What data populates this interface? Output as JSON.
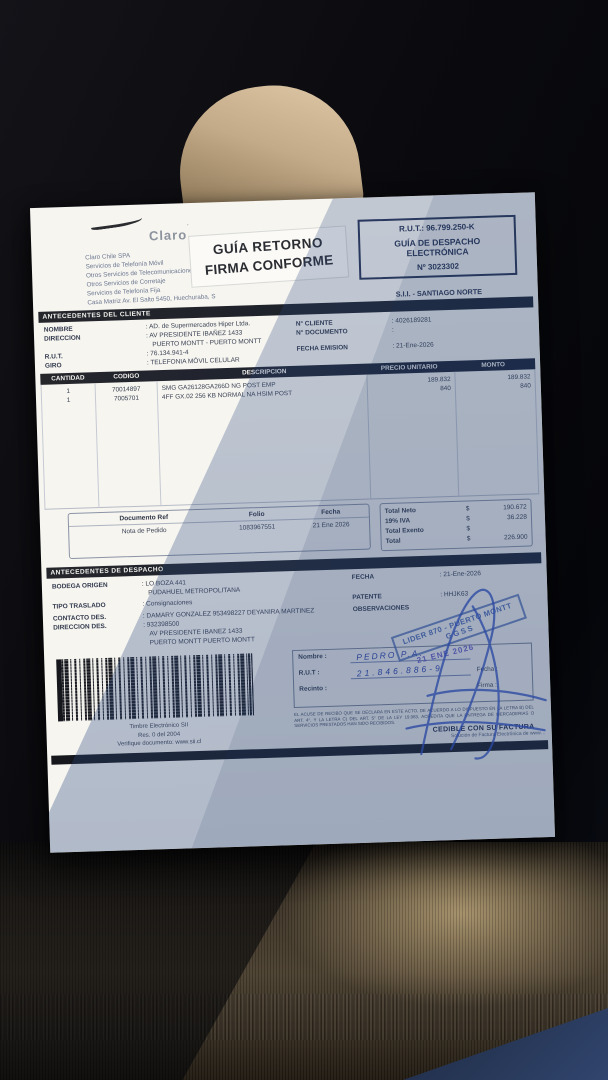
{
  "header": {
    "brand": "Claro",
    "brand_tick": "´",
    "company_lines": [
      "Claro Chile SPA",
      "Servicios de Telefonía Móvil",
      "Otros Servicios de Telecomunicaciones",
      "Otros Servicios de Corretaje",
      "Servicios de Telefonía Fija",
      "Casa Matriz Av. El Salto 5450, Huechuraba, S"
    ],
    "return_stamp": {
      "line1": "GUÍA RETORNO",
      "line2": "FIRMA CONFORME"
    },
    "rut_box": {
      "rut": "R.U.T.: 96.799.250-K",
      "type_line1": "GUÍA DE DESPACHO",
      "type_line2": "ELECTRÓNICA",
      "number": "Nº 3023302"
    },
    "sii_office": "S.I.I. - SANTIAGO NORTE"
  },
  "client": {
    "title": "ANTECEDENTES DEL CLIENTE",
    "nombre_label": "NOMBRE",
    "nombre": ":  AD. de Supermercados Hiper Ltda.",
    "direccion_label": "DIRECCION",
    "direccion1": ":  AV PRESIDENTE IBAÑEZ 1433",
    "direccion2": "PUERTO MONTT -  PUERTO MONTT",
    "rut_label": "R.U.T.",
    "rut": ":  76.134.941-4",
    "giro_label": "GIRO",
    "giro": ":  TELEFONIA MÓVIL CELULAR",
    "ncliente_label": "N° CLIENTE",
    "ncliente": ":  4026189281",
    "ndocumento_label": "N° DOCUMENTO",
    "ndocumento": ":",
    "fecha_label": "FECHA EMISION",
    "fecha": ":  21-Ene-2026"
  },
  "items": {
    "columns": [
      "CANTIDAD",
      "CODIGO",
      "DESCRIPCION",
      "PRECIO UNITARIO",
      "MONTO"
    ],
    "rows": [
      {
        "cantidad": "1",
        "codigo": "70014897",
        "descripcion": "SMG GA26128GA266D NG POST EMP",
        "precio": "189.832",
        "monto": "189.832"
      },
      {
        "cantidad": "1",
        "codigo": "7005701",
        "descripcion": "4FF GX.02 256 KB NORMAL NA HSIM POST",
        "precio": "840",
        "monto": "840"
      }
    ]
  },
  "reference": {
    "col_documento": "Documento Ref",
    "col_folio": "Folio",
    "col_fecha": "Fecha",
    "documento": "Nota de Pedido",
    "folio": "1083967551",
    "fecha": "21 Ene 2026"
  },
  "totals": {
    "rows": [
      {
        "label": "Total Neto",
        "cur": "$",
        "value": "190.672"
      },
      {
        "label": "19% IVA",
        "cur": "$",
        "value": "36.228"
      },
      {
        "label": "Total Exento",
        "cur": "$",
        "value": ""
      },
      {
        "label": "Total",
        "cur": "$",
        "value": "226.900"
      }
    ]
  },
  "despacho": {
    "title": "ANTECEDENTES DE DESPACHO",
    "bodega_label": "BODEGA ORIGEN",
    "bodega1": ":  LO BOZA 441",
    "bodega2": "PUDAHUEL  METROPOLITANA",
    "traslado_label": "TIPO TRASLADO",
    "traslado": ":  Consignaciones",
    "contacto_label": "CONTACTO DES.",
    "contacto": ":  DAMARY GONZALEZ 953498227 DEYANIRA MARTINEZ",
    "direccion_label": "DIRECCION DES.",
    "direccion1": ":  932398500",
    "direccion2": "AV PRESIDENTE IBANEZ 1433",
    "direccion3": "PUERTO MONTT   PUERTO MONTT",
    "fecha_label": "FECHA",
    "fecha": ":  21-Ene-2026",
    "patente_label": "PATENTE",
    "patente": ":  HHJK63",
    "observaciones_label": "OBSERVACIONES",
    "stamp_line1": "LIDER 870 - PUERTO MONTT",
    "stamp_line2": "GGSS"
  },
  "timbre": {
    "caption1": "Timbre Electrónico SII",
    "caption2": "Res. 0 del 2004",
    "caption3": "Verifique documento: www.sii.cl"
  },
  "receipt": {
    "nombre_label": "Nombre  :",
    "rut_label": "R.U.T  :",
    "recinto_label": "Recinto  :",
    "fecha_label": "Fecha :",
    "firma_label": "Firma :",
    "handwritten_name": "PEDRO  P.A.",
    "handwritten_rut": "21.846.886-9",
    "date_stamp": "21 ENE 2026",
    "fine_print": "EL ACUSE DE RECIBO QUE SE DECLARA EN ESTE ACTO, DE ACUERDO A LO DISPUESTO EN LA LETRA B) DEL ART. 4°, Y LA LETRA C) DEL ART. 5° DE LA LEY 19.983, ACREDITA QUE LA ENTREGA DE MERCADERIAS O SERVICIOS PRESTADOS HAN SIDO RECIBIDOS.",
    "cedible": "CEDIBLE CON SU FACTURA"
  },
  "footer": {
    "provider": "Solución de Factura Electrónica de www…"
  }
}
